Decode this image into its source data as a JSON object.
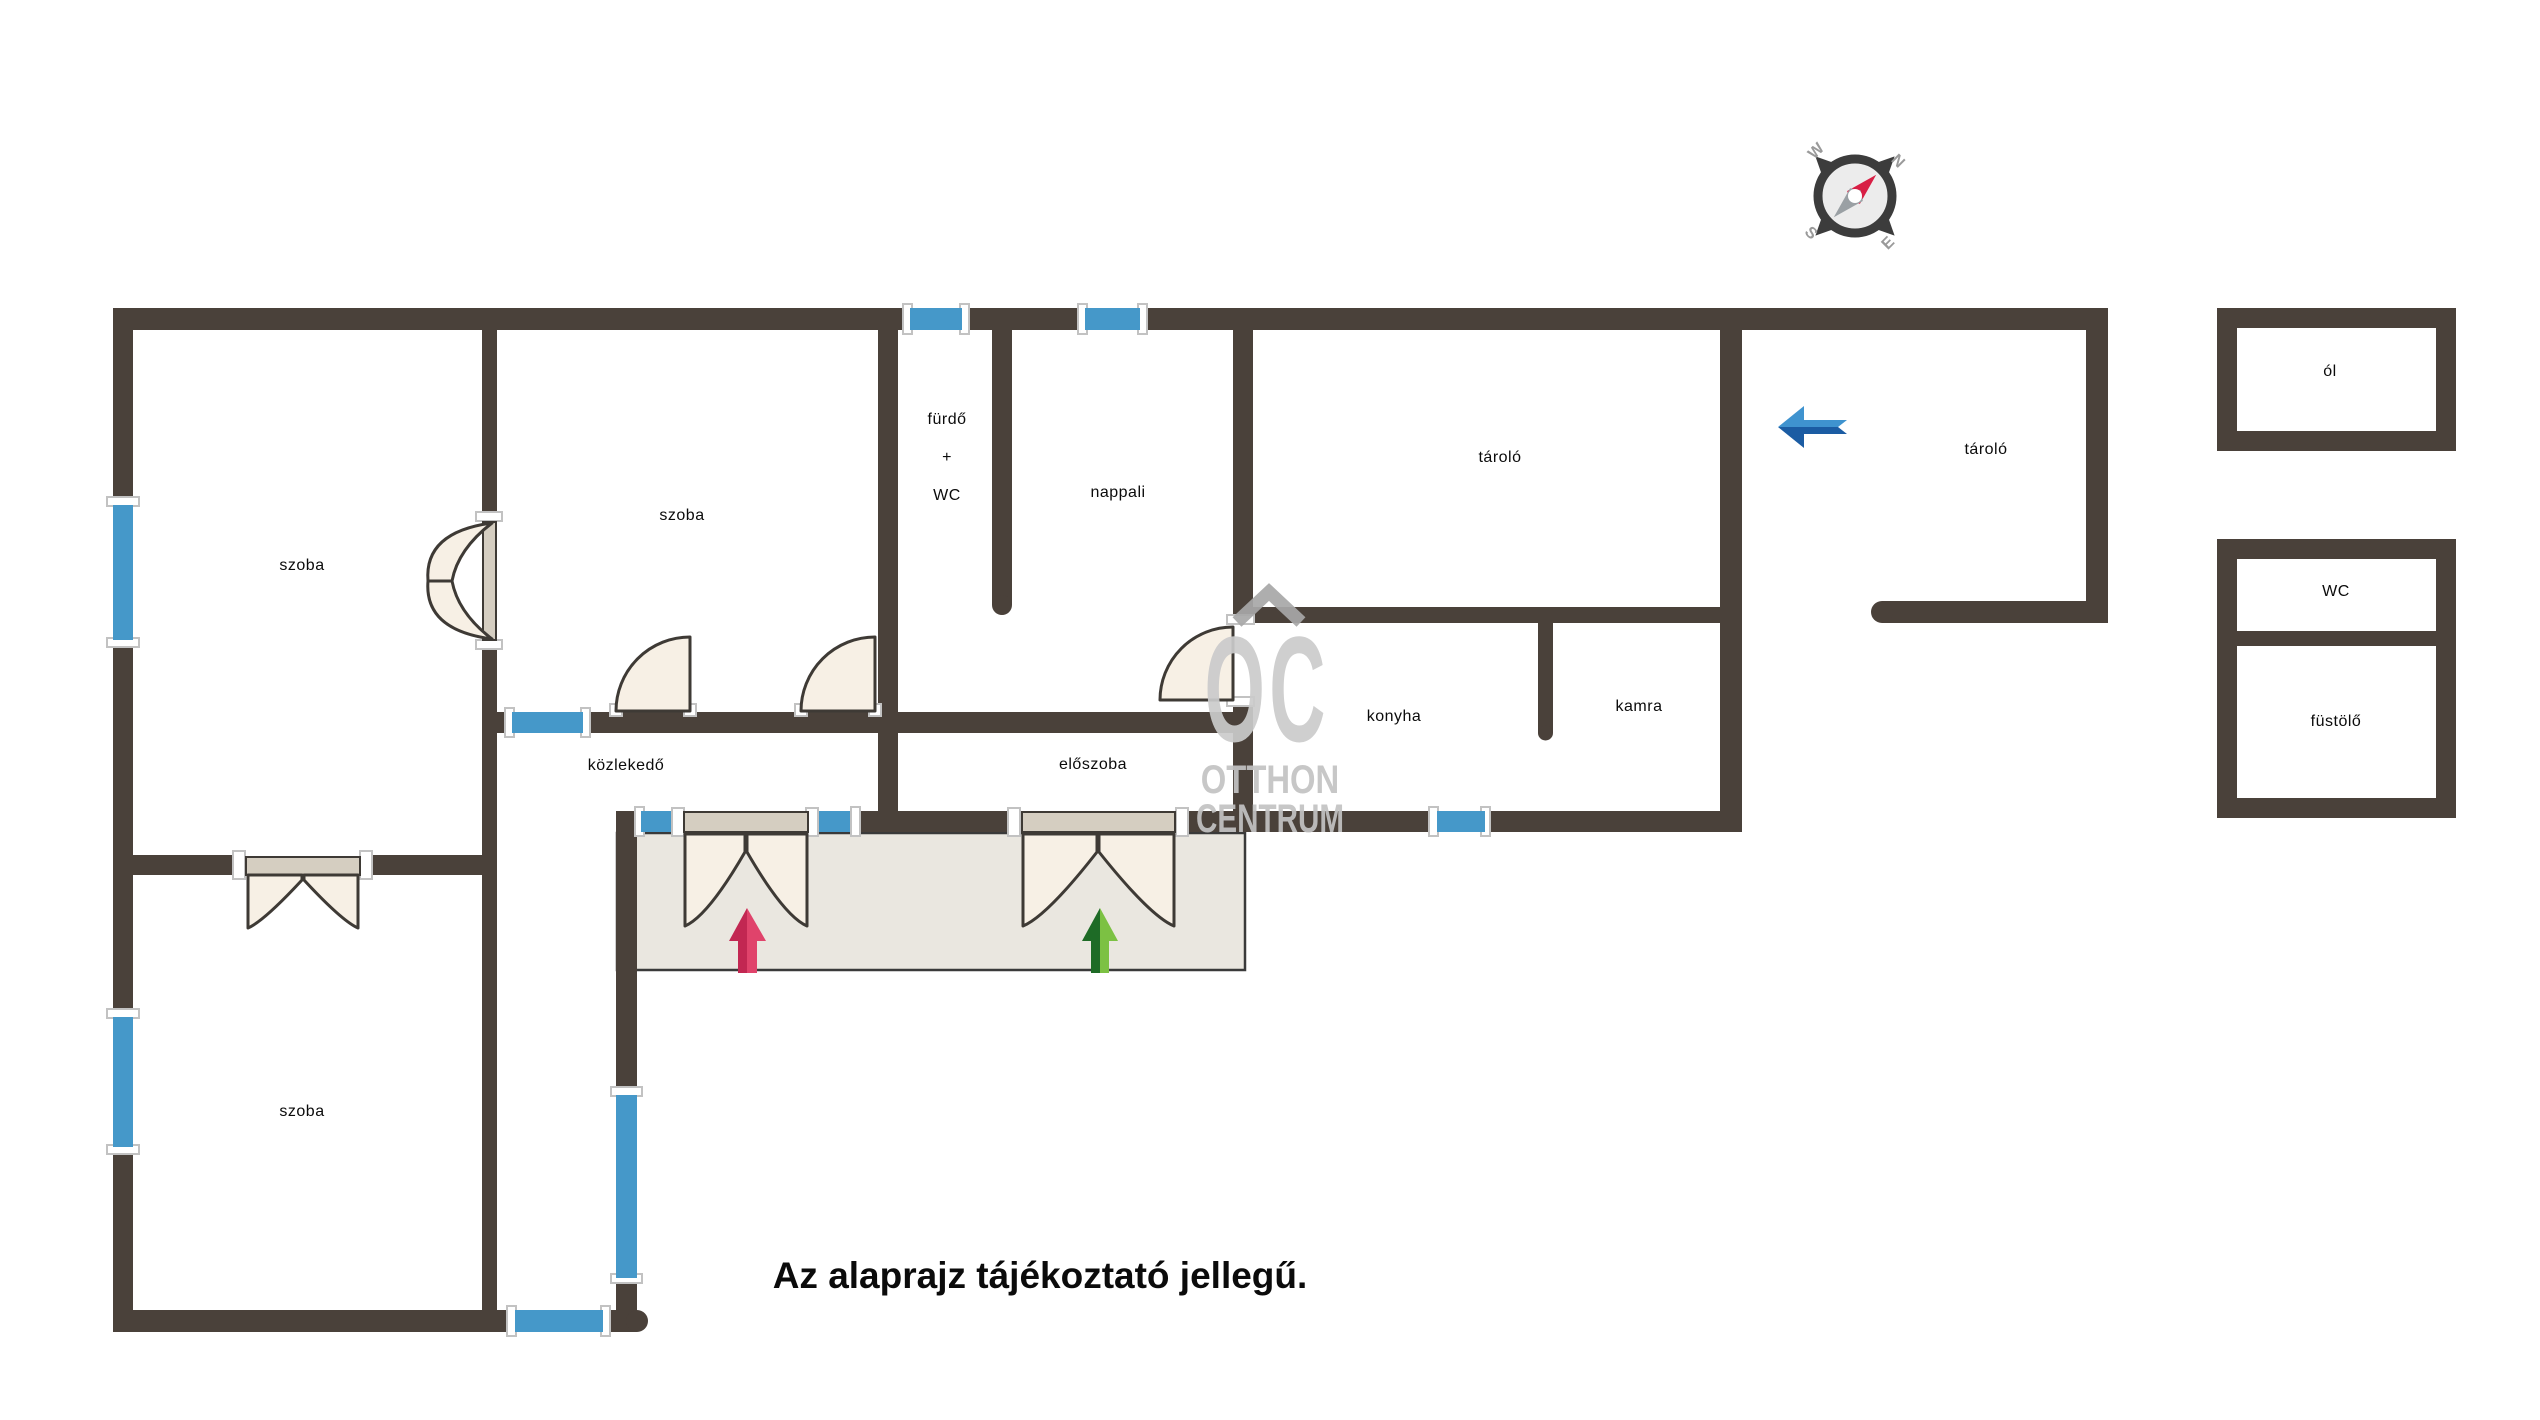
{
  "rooms": {
    "szoba1": {
      "label": "szoba"
    },
    "szoba2": {
      "label": "szoba"
    },
    "szoba3": {
      "label": "szoba"
    },
    "furdo": {
      "l1": "fürdő",
      "l2": "+",
      "l3": "WC"
    },
    "nappali": {
      "label": "nappali"
    },
    "tarolo1": {
      "label": "tároló"
    },
    "tarolo2": {
      "label": "tároló"
    },
    "konyha": {
      "label": "konyha"
    },
    "kamra": {
      "label": "kamra"
    },
    "kozlekedo": {
      "label": "közlekedő"
    },
    "eloszoba": {
      "label": "előszoba"
    }
  },
  "outbuildings": {
    "ol": {
      "label": "ól"
    },
    "wc": {
      "label": "WC"
    },
    "fustolo": {
      "label": "füstölő"
    }
  },
  "disclaimer": "Az alaprajz tájékoztató jellegű.",
  "watermark": {
    "logo": "OC",
    "line1": "OTTHON",
    "line2": "CENTRUM"
  },
  "compass": {
    "n": "N",
    "e": "E",
    "s": "S",
    "w": "W"
  },
  "colors": {
    "wall": "#4a413a",
    "window_blue": "#4598c9",
    "door_leaf": "#f7f0e5",
    "door_strip": "#d5cec1",
    "porch": "#eae7e0",
    "arrow_red": "#c22752",
    "arrow_red_light": "#e0436b",
    "arrow_green_dark": "#1e6b26",
    "arrow_green_light": "#7cc143",
    "arrow_blue_light": "#3f93cf",
    "arrow_blue_dark": "#1b5ca3",
    "compass_needle_red": "#d81f45",
    "watermark_gray": "#c9c9c9"
  }
}
